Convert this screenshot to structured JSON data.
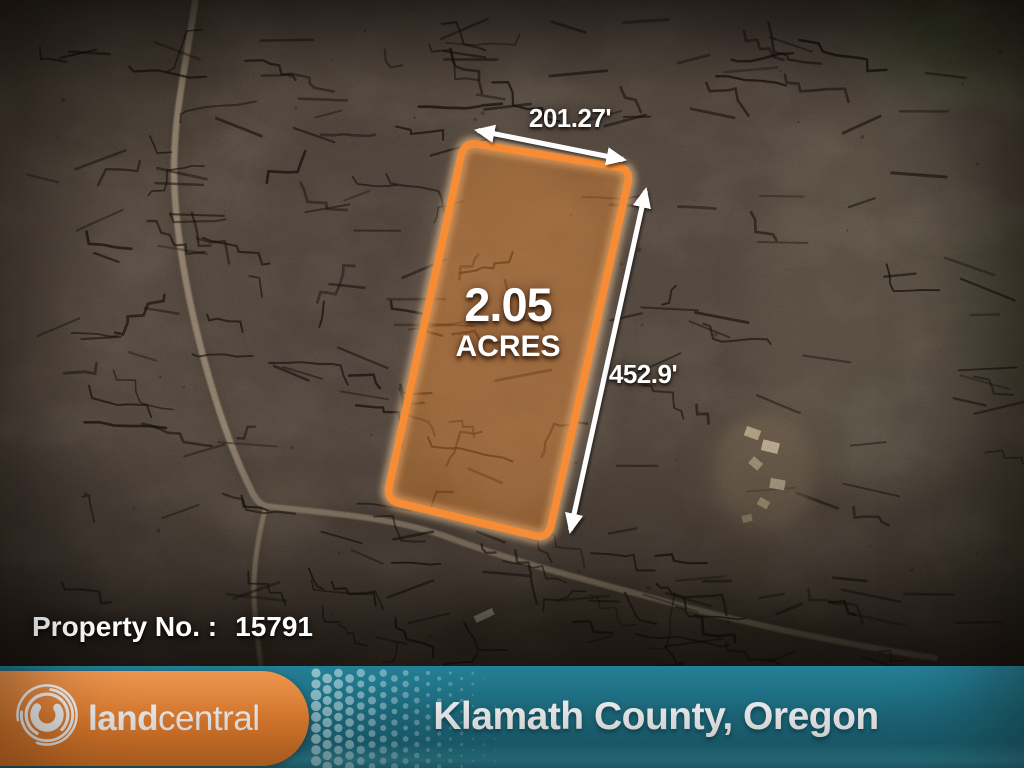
{
  "parcel": {
    "acreage": "2.05",
    "acres_label": "ACRES",
    "top_dimension": "201.27'",
    "side_dimension": "452.9'"
  },
  "property": {
    "label": "Property No. :",
    "number": "15791"
  },
  "footer": {
    "brand_bold": "land",
    "brand_light": "central",
    "location": "Klamath County, Oregon"
  },
  "icons": {
    "logo": "landcentral-swirl-icon",
    "width_arrow": "double-headed-arrow",
    "height_arrow": "double-headed-arrow"
  },
  "colors": {
    "brand_orange": "#EF8531",
    "parcel_orange": "#F78C35",
    "teal_bar": "#1F7286",
    "halftone_dot": "#B5DBE1",
    "text_white": "#FFFFFF"
  }
}
